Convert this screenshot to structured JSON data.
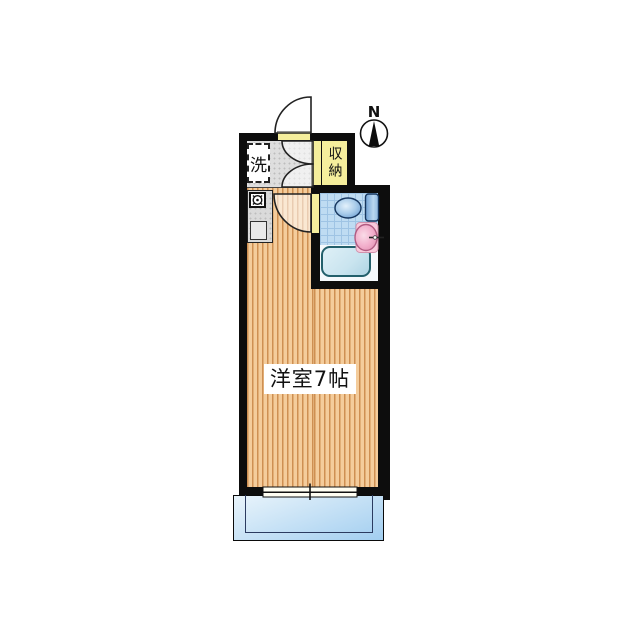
{
  "plan": {
    "room_label": "洋室7帖",
    "closet_label": "収納",
    "laundry_label": "洗",
    "compass_label": "N"
  },
  "rooms": {
    "main_room": "洋室7帖 (Western-style room, 7 mats)",
    "closet": "収納 (storage)",
    "laundry": "洗 (washer space)",
    "fixtures": [
      "toilet",
      "wash-basin",
      "bathtub",
      "kitchen-stove",
      "kitchen-sink",
      "entrance-door",
      "closet-double-doors",
      "bathroom-door",
      "sliding-window",
      "balcony",
      "north-compass"
    ]
  },
  "colors": {
    "wall": "#0d0d0d",
    "floor-light": "#F4CC9B",
    "floor-dark": "#CE8F52",
    "entrance-gray": "#DEDEDE",
    "closet-yellow": "#F5EE9C",
    "tile-blue": "#BFDCF2",
    "tile-grid": "#9FC4E4",
    "tub-fill": "#C9E4EF",
    "tub-border": "#23606C",
    "sink-pink": "#F2AECB",
    "toilet-blue": "#7FACD9",
    "balcony-top": "#E9F4FB",
    "balcony-bottom": "#A2CEF0"
  }
}
